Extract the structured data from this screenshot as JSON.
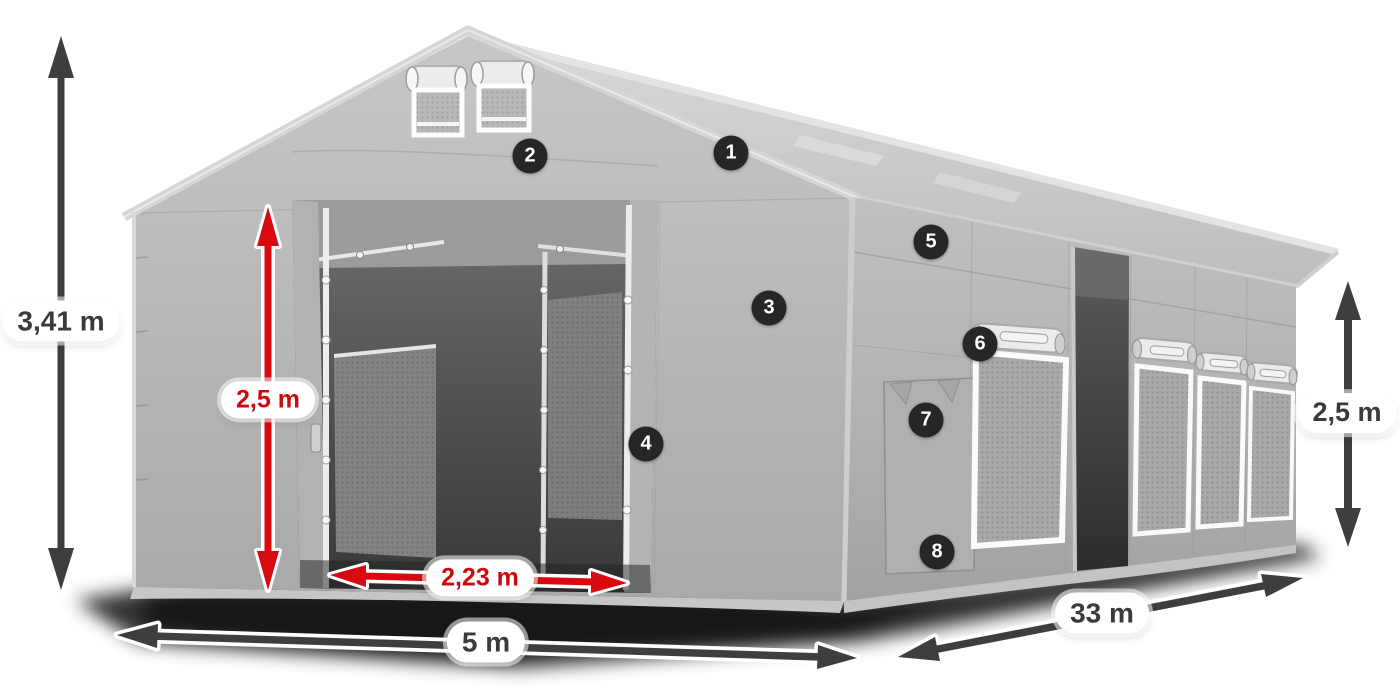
{
  "dimensions": {
    "total_height": {
      "label": "3,41 m",
      "style": "dark"
    },
    "door_height": {
      "label": "2,5 m",
      "style": "red"
    },
    "door_width": {
      "label": "2,23 m",
      "style": "red"
    },
    "front_width": {
      "label": "5 m",
      "style": "dark"
    },
    "side_length": {
      "label": "33 m",
      "style": "dark"
    },
    "side_wall_height": {
      "label": "2,5 m",
      "style": "dark"
    }
  },
  "markers": [
    {
      "number": "1"
    },
    {
      "number": "2"
    },
    {
      "number": "3"
    },
    {
      "number": "4"
    },
    {
      "number": "5"
    },
    {
      "number": "6"
    },
    {
      "number": "7"
    },
    {
      "number": "8"
    }
  ],
  "colors": {
    "arrow_dark": "#3e3e3e",
    "arrow_red": "#d8090f",
    "label_text_dark": "#3a3a3a",
    "label_text_red": "#cc0a0e",
    "badge_background": "#262626",
    "badge_text": "#ffffff",
    "tent_fabric_light": "#cccccc",
    "tent_fabric_mid": "#b0b0b0",
    "tent_interior_dark": "#3c3c3c"
  }
}
